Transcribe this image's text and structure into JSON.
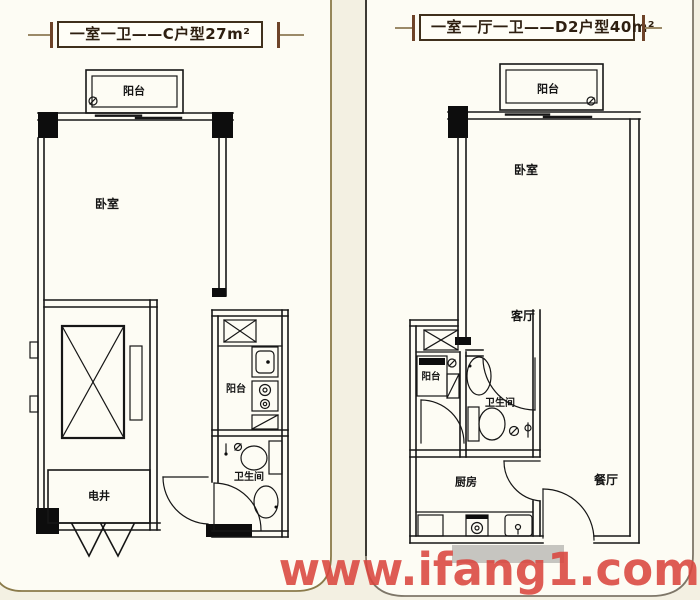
{
  "page": {
    "background": "#f3f0e2",
    "watermark": {
      "text": "www.ifang1.com",
      "color": "#da463e"
    }
  },
  "plans": {
    "left": {
      "title": "一室一卫——C户型27m²",
      "rooms": {
        "balcony_top": "阳台",
        "bedroom": "卧室",
        "balcony_side": "阳台",
        "bathroom": "卫生间",
        "utility_shaft": "电井"
      }
    },
    "right": {
      "title": "一室一厅一卫——D2户型40m²",
      "rooms": {
        "balcony_top": "阳台",
        "bedroom": "卧室",
        "living_room": "客厅",
        "balcony_side": "阳台",
        "bathroom": "卫生间",
        "kitchen": "厨房",
        "dining_room": "餐厅"
      }
    }
  },
  "colors": {
    "card_frame_left": "#8a7a4a",
    "card_frame_right": "#7d7668",
    "card_edge_dark": "#3c3a34",
    "wall_ink": "#161616",
    "title_ink": "#2e1f10",
    "title_decor": "#6e4328",
    "watermark_red": "#da463e"
  }
}
